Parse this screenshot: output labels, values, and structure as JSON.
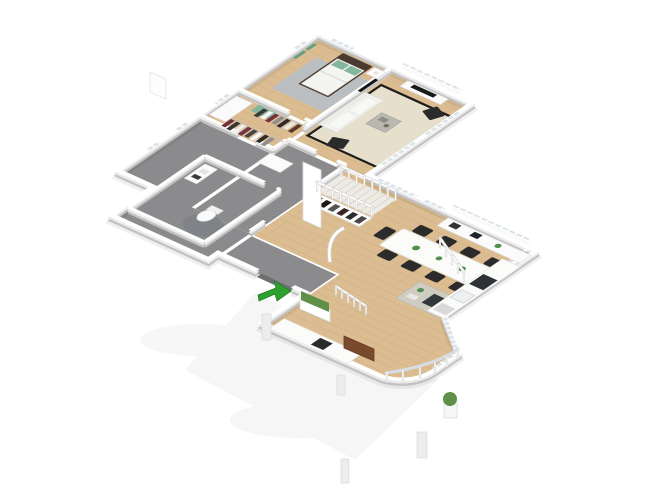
{
  "scene": {
    "kind": "3d-isometric-floor-plan-render",
    "background": "#ffffff",
    "view": "axonometric top-down, rotated",
    "visible_text": ""
  },
  "palette": {
    "wood": "#dcbd92",
    "wood_line": "#c8a87a",
    "gray_floor": "#8b8b8d",
    "wall_top": "#ffffff",
    "wall_mid": "#ebebeb",
    "wall_base": "#c2c2c2",
    "wall_shadow": "rgba(0,0,0,0.06)",
    "glass": "#dce4ea",
    "rug_living": "#e6dfcb",
    "rug_border": "#1c1c1c",
    "rug_bedroom": "#b7bfc7",
    "rug_bath": "#7f8286",
    "sofa": "#f3f3f0",
    "cushion": "#f8f8f5",
    "chair_dark": "#2b2b2b",
    "table_white": "#fbfbfa",
    "island": "#cfccc2",
    "cooktop": "#33383c",
    "sink": "#eef1f3",
    "appliance_dark": "#2e3236",
    "bed_frame": "#4b3a2f",
    "mattress": "#f4f4f1",
    "pillow_green": "#83b79b",
    "art_green": "#60a17e",
    "bench_green": "#83b79b",
    "stair": "#eeebe5",
    "stair_line": "#d8d4cd",
    "furniture_stroke": "#dedede",
    "wood_bench": "#7a4a2e",
    "hedge": "#5f9048",
    "arrow_green": "#2da12d",
    "terrace": "#f3f3f3",
    "doorway_dark": "#6f6f71",
    "closet_item_a": "#3b3b3b",
    "closet_item_b": "#f5f5f5",
    "closet_item_c": "#74303c"
  },
  "rooms": [
    {
      "name": "bedroom",
      "floor": "wood"
    },
    {
      "name": "walk-in-closet",
      "floor": "wood"
    },
    {
      "name": "bathroom",
      "floor": "gray"
    },
    {
      "name": "hallway",
      "floor": "gray"
    },
    {
      "name": "entry",
      "floor": "gray"
    },
    {
      "name": "living-room",
      "floor": "wood"
    },
    {
      "name": "dining-room",
      "floor": "wood"
    },
    {
      "name": "kitchen",
      "floor": "wood"
    }
  ],
  "furniture": {
    "bedroom": [
      "double-bed",
      "green-pillows",
      "nightstand",
      "gray-rug",
      "wall-tv",
      "green-wall-art"
    ],
    "walk_in_closet": [
      "clothes-rail-north",
      "clothes-rail-south",
      "wardrobe-cabinet",
      "green-bench"
    ],
    "bathroom": [
      "toilet",
      "vanity",
      "round-gray-rug"
    ],
    "hallway": [
      "storage-cabinet",
      "open-wardrobe",
      "white-door-leaf"
    ],
    "living_room": [
      "white-sofa",
      "coffee-table",
      "two-black-armchairs",
      "bordered-cream-rug",
      "tv-sideboard",
      "staircase-with-railing"
    ],
    "dining_room": [
      "long-white-table",
      "black-chairs",
      "table-plants",
      "sideboard-cabinets"
    ],
    "kitchen": [
      "island-with-cooktop",
      "counter-with-sink",
      "dark-appliances",
      "curved-glass-bay"
    ],
    "exterior": [
      "entrance-arrow",
      "hedge-planter",
      "wood-bench",
      "potted-plant",
      "fence-posts",
      "bollard-posts",
      "terrace"
    ]
  },
  "counts": {
    "dining_chairs": 9,
    "living_armchairs": 2,
    "stair_balusters": 8,
    "bay_posts": 6
  }
}
